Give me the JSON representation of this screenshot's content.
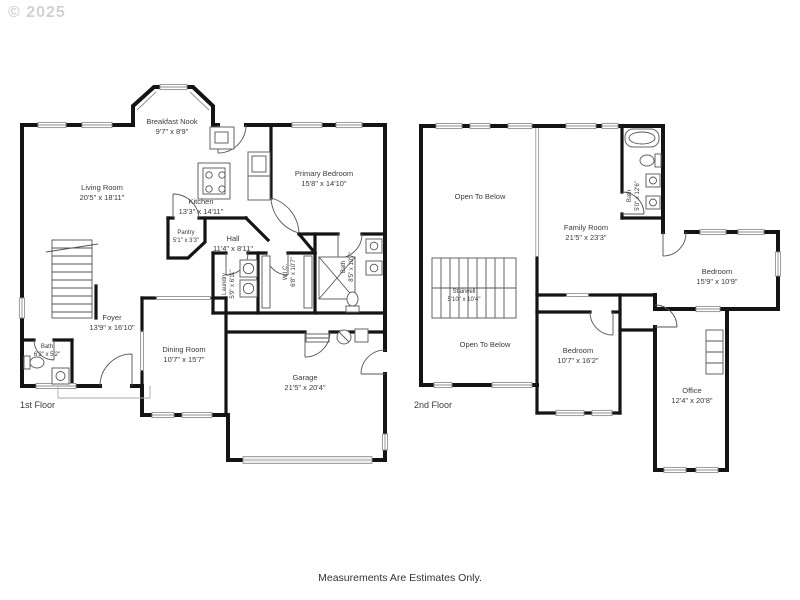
{
  "watermark": "© 2025",
  "footer": "Measurements Are Estimates Only.",
  "colors": {
    "wall": "#141414",
    "label": "#3a3a3a",
    "watermark": "#cfd2d4"
  },
  "floor1": {
    "label": "1st Floor",
    "rooms": {
      "breakfast_nook": {
        "name": "Breakfast Nook",
        "dims": "9'7\" x 8'9\""
      },
      "living_room": {
        "name": "Living Room",
        "dims": "20'5\" x 18'11\""
      },
      "kitchen": {
        "name": "Kitchen",
        "dims": "13'3\" x 14'11\""
      },
      "primary_bedroom": {
        "name": "Primary Bedroom",
        "dims": "15'8\" x 14'10\""
      },
      "pantry": {
        "name": "Pantry",
        "dims": "5'1\" x 3'3\""
      },
      "hall": {
        "name": "Hall",
        "dims": "11'4\" x 8'11\""
      },
      "laundry": {
        "name": "Laundry",
        "dims": "5'9\" x 6'11\""
      },
      "wic": {
        "name": "W.I.C.",
        "dims": "6'8\" x 10'7\""
      },
      "primary_bath": {
        "name": "Bath",
        "dims": "8'5\" x 10'7\""
      },
      "foyer": {
        "name": "Foyer",
        "dims": "13'9\" x 16'10\""
      },
      "bath": {
        "name": "Bath",
        "dims": "6'2\" x 5'2\""
      },
      "dining_room": {
        "name": "Dining Room",
        "dims": "10'7\" x 15'7\""
      },
      "garage": {
        "name": "Garage",
        "dims": "21'5\" x 20'4\""
      }
    }
  },
  "floor2": {
    "label": "2nd Floor",
    "rooms": {
      "open_to_below_upper": {
        "name": "Open To Below",
        "dims": ""
      },
      "family_room": {
        "name": "Family Room",
        "dims": "21'5\" x 23'3\""
      },
      "bath": {
        "name": "Bath",
        "dims": "5'0\" x 12'6\""
      },
      "stairwell": {
        "name": "Stairwell",
        "dims": "5'10\" x 10'4\""
      },
      "open_to_below_lower": {
        "name": "Open To Below",
        "dims": ""
      },
      "bedroom_mid": {
        "name": "Bedroom",
        "dims": "10'7\" x 16'2\""
      },
      "bedroom_right": {
        "name": "Bedroom",
        "dims": "15'9\" x 10'9\""
      },
      "office": {
        "name": "Office",
        "dims": "12'4\" x 20'8\""
      }
    }
  }
}
